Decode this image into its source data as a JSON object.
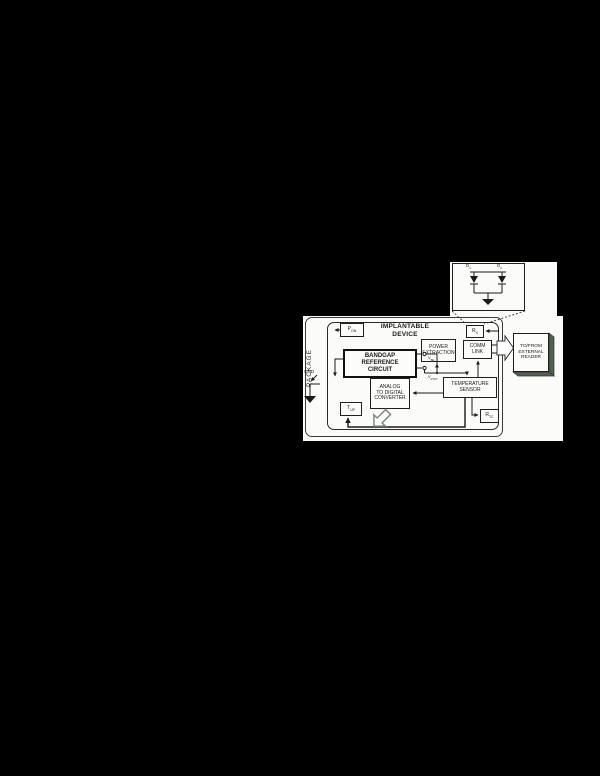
{
  "diagram": {
    "package_label": "PACKAGE",
    "device_title": {
      "line1": "IMPLANTABLE",
      "line2": "DEVICE"
    },
    "blocks": {
      "bandgap": {
        "line1": "BANDGAP",
        "line2": "REFERENCE",
        "line3": "CIRCUIT"
      },
      "power_extraction": {
        "line1": "POWER",
        "line2": "EXTRACTION"
      },
      "comm_link": {
        "line1": "COMM",
        "line2": "LINK"
      },
      "adc": {
        "line1": "ANALOG",
        "line2": "TO DIGITAL",
        "line3": "CONVERTER"
      },
      "temperature_sensor": {
        "line1": "TEMPERATURE",
        "line2": "SENSOR"
      },
      "reader": {
        "line1": "TO/FROM",
        "line2": "EXTERNAL",
        "line3": "READER"
      }
    },
    "ports": {
      "p_on": {
        "base": "P",
        "sub": "ON"
      },
      "r_x": {
        "base": "R",
        "sub": "X"
      },
      "t_up": {
        "base": "T",
        "sub": "UP"
      },
      "r_tc": {
        "base": "R",
        "sub": "TC"
      }
    },
    "gnd_label": "GND",
    "callout": {
      "d1": {
        "base": "D",
        "sub": "1"
      },
      "d2": {
        "base": "D",
        "sub": "2"
      }
    },
    "signals": {
      "v_be": {
        "base": "V",
        "sub": "BE"
      },
      "v_ptat": {
        "base": "V",
        "sub": "PTAT"
      }
    },
    "colors": {
      "background": "#000000",
      "paper": "#fbfbf9",
      "ink": "#1a1a1a",
      "shadow_green": "#4f614f",
      "arrow_outline": "#7d8d7d"
    }
  }
}
